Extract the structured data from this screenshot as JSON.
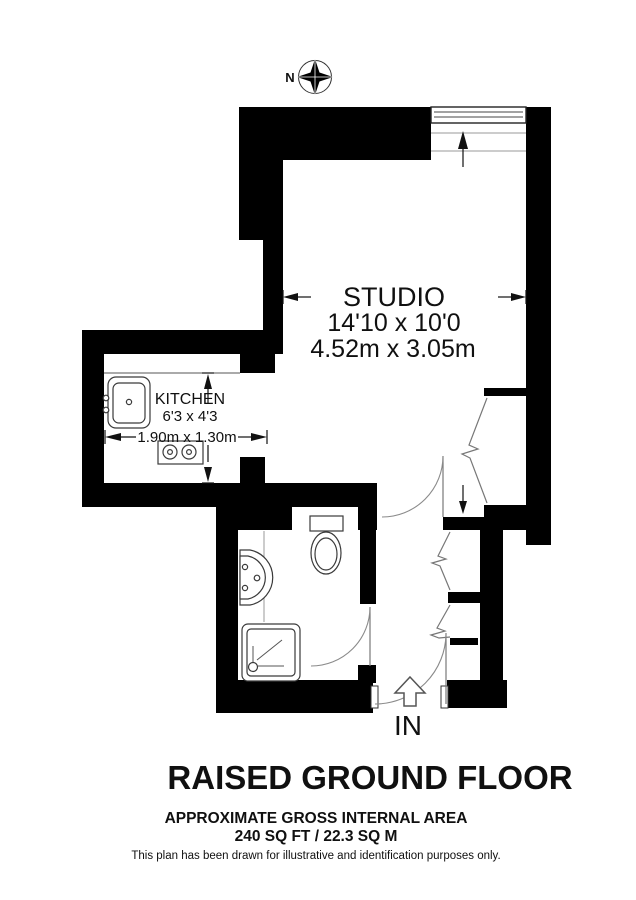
{
  "compass": {
    "north_label": "N"
  },
  "rooms": {
    "studio": {
      "name": "STUDIO",
      "dimensions_imperial": "14'10 x 10'0",
      "dimensions_metric": "4.52m x 3.05m"
    },
    "kitchen": {
      "name": "KITCHEN",
      "dimensions_imperial": "6'3 x 4'3",
      "dimensions_metric": "1.90m x 1.30m"
    }
  },
  "entrance": {
    "label": "IN"
  },
  "footer": {
    "floor_title": "RAISED GROUND FLOOR",
    "area_heading": "APPROXIMATE GROSS INTERNAL AREA",
    "area_value": "240 SQ FT / 22.3 SQ M",
    "disclaimer": "This plan has been drawn for illustrative and identification purposes only."
  },
  "colors": {
    "wall": "#000000",
    "background": "#ffffff",
    "fixture_stroke": "#3a3a3a"
  }
}
